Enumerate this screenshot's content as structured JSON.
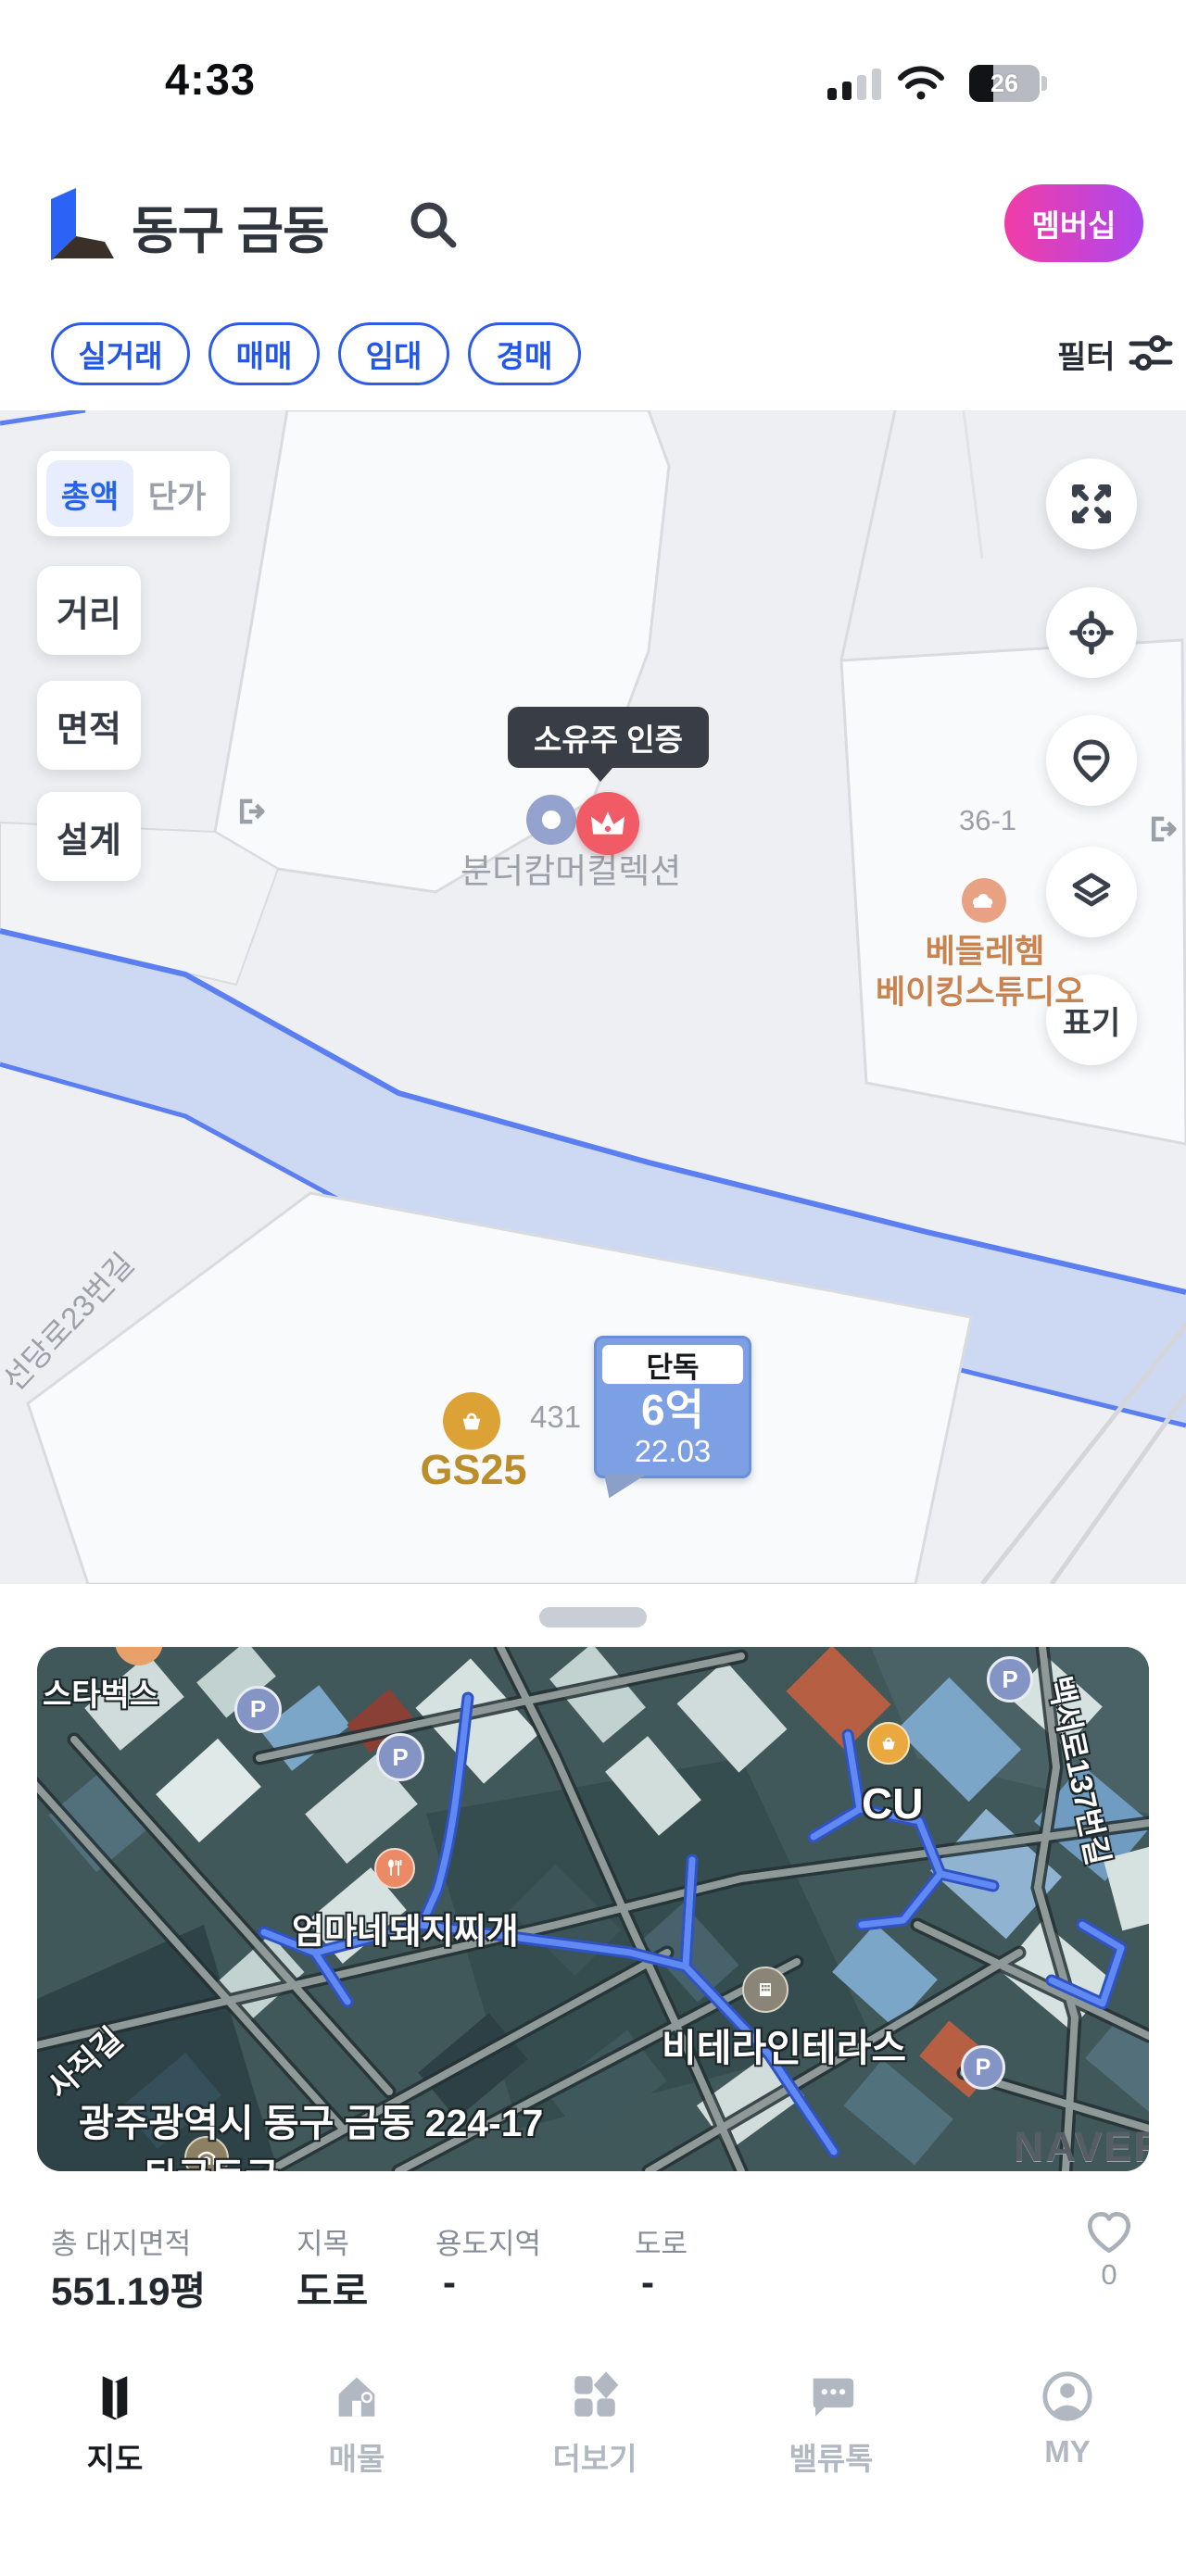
{
  "status_bar": {
    "time": "4:33",
    "battery_percent": "26"
  },
  "header": {
    "title": "동구 금동",
    "membership_label": "멤버십"
  },
  "filter_bar": {
    "chips": [
      "실거래",
      "매매",
      "임대",
      "경매"
    ],
    "filter_label": "필터"
  },
  "map": {
    "toggle": {
      "selected": "총액",
      "unselected": "단가"
    },
    "left_buttons": [
      "거리",
      "면적",
      "설계"
    ],
    "mark_button_label": "표기",
    "tooltip": "소유주 인증",
    "labels": {
      "wunderkammer": "분더캄머컬렉션",
      "parcel_36": "36-1",
      "bakery_line1": "베들레헴",
      "bakery_line2": "베이킹스튜디오",
      "gs25": "GS25",
      "parcel_431": "431",
      "road": "선당로23번길"
    },
    "price_marker": {
      "type": "단독",
      "price": "6억",
      "date": "22.03"
    }
  },
  "bottom_sheet": {
    "satellite_labels": {
      "starbucks": "스타벅스",
      "restaurant": "엄마네돼지찌개",
      "cu": "CU",
      "road_right": "백서로137번길",
      "road_left": "사직길",
      "cave": "뒷굴동굴",
      "terrace": "비테라인테라스",
      "address": "광주광역시 동구 금동 224-17",
      "parking": "P",
      "watermark": "NAVER"
    },
    "info": {
      "columns": [
        {
          "label": "총 대지면적",
          "value": "551.19평"
        },
        {
          "label": "지목",
          "value": "도로"
        },
        {
          "label": "용도지역",
          "value": "-"
        },
        {
          "label": "도로",
          "value": "-"
        }
      ],
      "favorite_count": "0"
    }
  },
  "bottom_nav": {
    "items": [
      {
        "label": "지도",
        "active": true
      },
      {
        "label": "매물",
        "active": false
      },
      {
        "label": "더보기",
        "active": false
      },
      {
        "label": "밸류톡",
        "active": false
      },
      {
        "label": "MY",
        "active": false
      }
    ]
  },
  "colors": {
    "accent_blue": "#2257e7",
    "membership_gradient": [
      "#f23ca6",
      "#ae47ee"
    ],
    "marker_red": "#f15b66",
    "price_bubble_blue": "#7d9fe3",
    "river_fill": "#cdd9f3",
    "river_stroke": "#5b7ef0",
    "bakery_orange": "#c8834e",
    "gs25_gold": "#b98d2a"
  }
}
